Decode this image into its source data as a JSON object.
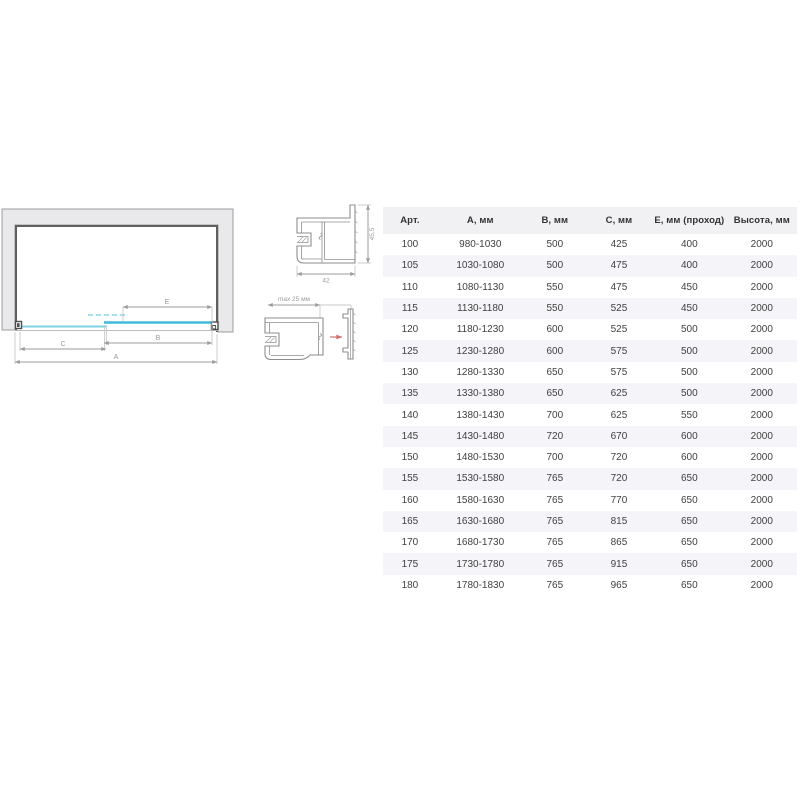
{
  "diagram": {
    "labels": {
      "a": "A",
      "b": "B",
      "c": "C",
      "e": "E"
    }
  },
  "profiles": {
    "top": {
      "width_label": "42",
      "height_label": "45,5"
    },
    "bottom": {
      "adjustment_label": "max 25 мм"
    }
  },
  "table": {
    "columns": [
      "Арт.",
      "А, мм",
      "В, мм",
      "С, мм",
      "Е, мм (проход)",
      "Высота, мм"
    ],
    "rows": [
      [
        "100",
        "980-1030",
        "500",
        "425",
        "400",
        "2000"
      ],
      [
        "105",
        "1030-1080",
        "500",
        "475",
        "400",
        "2000"
      ],
      [
        "110",
        "1080-1130",
        "550",
        "475",
        "450",
        "2000"
      ],
      [
        "115",
        "1130-1180",
        "550",
        "525",
        "450",
        "2000"
      ],
      [
        "120",
        "1180-1230",
        "600",
        "525",
        "500",
        "2000"
      ],
      [
        "125",
        "1230-1280",
        "600",
        "575",
        "500",
        "2000"
      ],
      [
        "130",
        "1280-1330",
        "650",
        "575",
        "500",
        "2000"
      ],
      [
        "135",
        "1330-1380",
        "650",
        "625",
        "500",
        "2000"
      ],
      [
        "140",
        "1380-1430",
        "700",
        "625",
        "550",
        "2000"
      ],
      [
        "145",
        "1430-1480",
        "720",
        "670",
        "600",
        "2000"
      ],
      [
        "150",
        "1480-1530",
        "700",
        "720",
        "600",
        "2000"
      ],
      [
        "155",
        "1530-1580",
        "765",
        "720",
        "650",
        "2000"
      ],
      [
        "160",
        "1580-1630",
        "765",
        "770",
        "650",
        "2000"
      ],
      [
        "165",
        "1630-1680",
        "765",
        "815",
        "650",
        "2000"
      ],
      [
        "170",
        "1680-1730",
        "765",
        "865",
        "650",
        "2000"
      ],
      [
        "175",
        "1730-1780",
        "765",
        "915",
        "650",
        "2000"
      ],
      [
        "180",
        "1780-1830",
        "765",
        "965",
        "650",
        "2000"
      ]
    ]
  },
  "colors": {
    "glass_slider": "#3fbbd8",
    "glass_fixed": "#7fd0e2",
    "glass_dashed": "#a8e0ec",
    "wall_fill": "#e9e9ec",
    "wall_border": "#9c9c9c",
    "frame_dark": "#5f5f5f",
    "dimension": "#9b9b9b",
    "profile_line": "#8e8e8e",
    "accent_red": "#d27070",
    "header_bg": "#f1f1f3",
    "row_alt_bg": "#f4f4f9"
  }
}
